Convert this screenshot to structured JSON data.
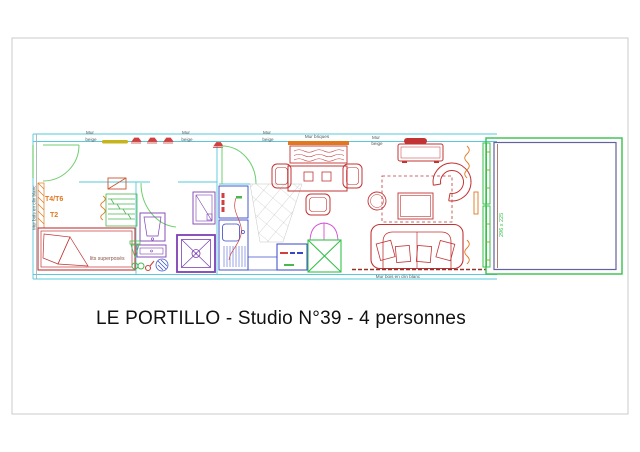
{
  "title": "LE PORTILLO - Studio N°39 - 4 personnes",
  "wall_labels": {
    "top": [
      {
        "line1": "Mur",
        "line2": "beige"
      },
      {
        "line1": "Mur",
        "line2": "beige"
      },
      {
        "line1": "Mur",
        "line2": "beige"
      },
      {
        "line1": "Mur briques"
      },
      {
        "line1": "Mur",
        "line2": "beige"
      }
    ],
    "left_vertical": "Mur bois en clin blanc",
    "bottom": "Mur bois en clin blanc"
  },
  "annotations": {
    "unit_label_1": "T4/T6",
    "unit_label_2": "T2",
    "bed_label": "lits superposés",
    "balcony_dimension": "296 x 225"
  },
  "colors": {
    "wall_cyan": "#56c9db",
    "furniture_red": "#c23434",
    "door_green": "#6fcf6f",
    "bright_green": "#35c24a",
    "fixture_purple": "#7d3fb3",
    "kitchen_blue": "#3646c8",
    "accent_orange": "#e07820",
    "magenta": "#d34fd3",
    "dark_red": "#90322a",
    "tile_grey": "#b8b8b8",
    "label_grey": "#555555",
    "yellow_bar": "#c6b41c"
  }
}
